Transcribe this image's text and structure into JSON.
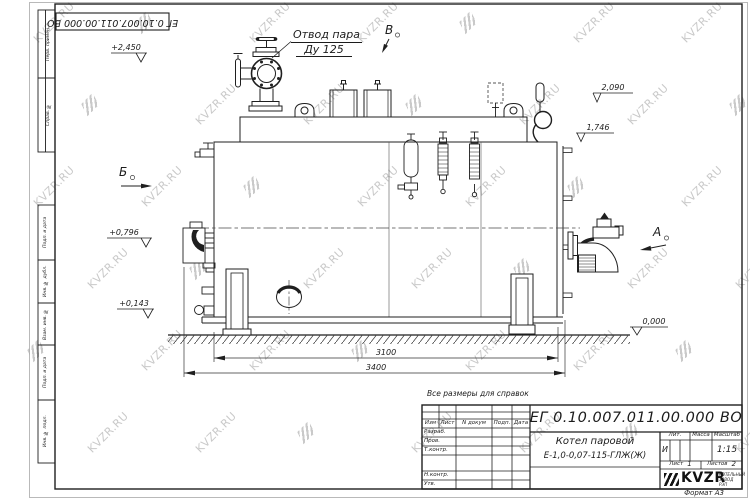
{
  "watermark": {
    "text": "KVZR.RU"
  },
  "top_stamp": {
    "doc_number": "ЕГ 0.10.007.011.00.000  ВО"
  },
  "margin_labels": [
    "Перв. примен.",
    "Справ. №",
    "Подп. и дата",
    "Инв. № дубл.",
    "Взам. инв. №",
    "Подп. и дата",
    "Инв. № подл."
  ],
  "annotations": {
    "steam_outlet_line1": "Отвод пара",
    "steam_outlet_line2": "Ду 125",
    "view_b": "Б",
    "view_v": "В",
    "view_a": "А",
    "levels": [
      "+2,450",
      "+0,796",
      "+0,143",
      "2,090",
      "1,746",
      "0,000"
    ],
    "dims": [
      "3100",
      "3400"
    ],
    "note": "Все размеры для справок"
  },
  "title_block": {
    "doc_number": "ЕГ 0.10.007.011.00.000  ВО",
    "name_line1": "Котел паровой",
    "name_line2": "Е-1,0-0,07-115-ГЛЖ(Ж)",
    "cols": [
      "Изм",
      "Лист",
      "N докум",
      "Подп.",
      "Дата"
    ],
    "sign_rows": [
      "Разраб.",
      "Пров.",
      "Т.контр.",
      "Н.контр.",
      "Утв."
    ],
    "lit_label": "Лит.",
    "mass_label": "Масса",
    "scale_label": "Масштаб",
    "lit_value": "И",
    "scale_value": "1:15",
    "sheet_label": "Лист",
    "sheet_value": "1",
    "sheets_label": "Листов",
    "sheets_value": "2",
    "logo_text": "KVZR",
    "logo_caption1": "КОТЕЛЬНЫЙ",
    "logo_caption2": "ЗАВОД РЭП",
    "format_label": "Формат А3"
  }
}
